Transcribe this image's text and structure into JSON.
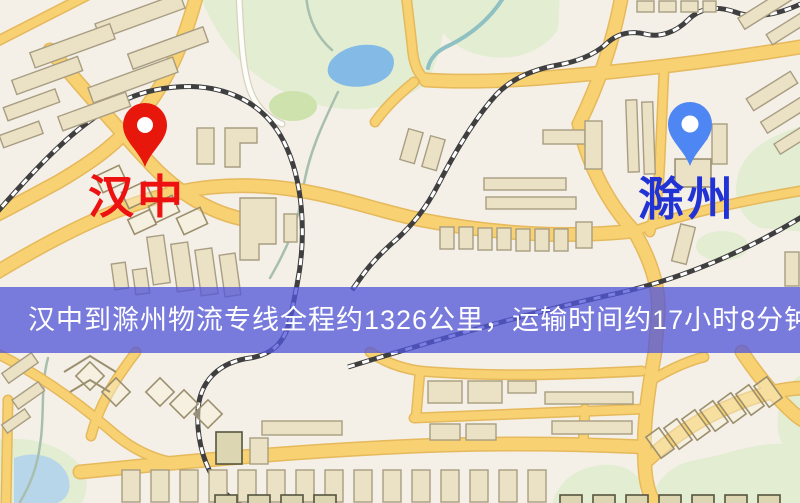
{
  "map": {
    "markers": {
      "origin": {
        "label": "汉中",
        "pin_color": "#e8170c",
        "label_color": "#ee1111"
      },
      "destination": {
        "label": "滁州",
        "pin_color": "#4e86f3",
        "label_color": "#2233d6"
      }
    },
    "banner": {
      "text": "汉中到滁州物流专线全程约1326公里，运输时间约17小时8分钟.",
      "origin": "汉中",
      "destination": "滁州",
      "distance_text": "约1326公里",
      "duration_text": "约17小时8分钟",
      "bg_color": "#5156d9",
      "text_color": "#ffffff"
    },
    "palette": {
      "background": "#f5f0e7",
      "road_fill": "#f7d172",
      "road_border": "#e5b95c",
      "minor_road_white": "#fdfdfa",
      "building_fill": "#ebe2c6",
      "building_stroke": "#a89d82",
      "park_green": "#e2edd2",
      "dark_green": "#cde2ac",
      "water_blue": "#84bbe6",
      "water_pale": "#b7d6ea",
      "railway_dark": "#3f3f3f",
      "railway_light": "#ffffff"
    }
  }
}
